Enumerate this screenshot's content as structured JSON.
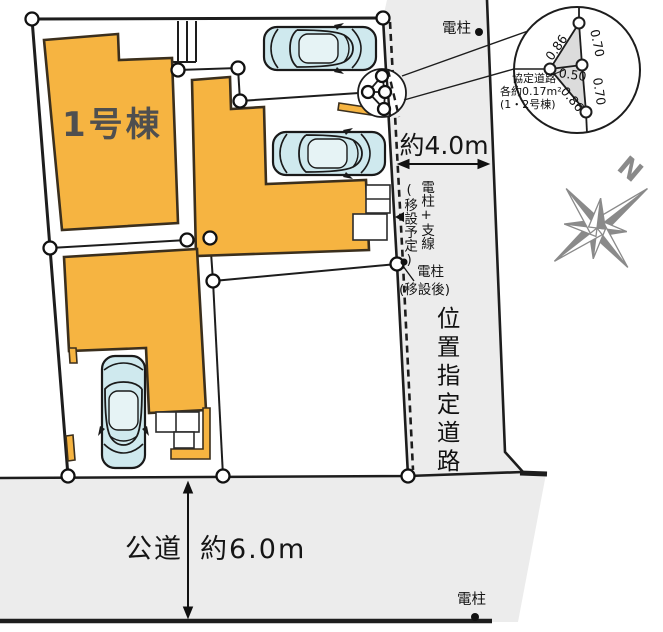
{
  "plan": {
    "building1_label": "1号棟",
    "road_right_name": "位置指定道路",
    "road_right_width": "約4.0m",
    "road_bottom_name": "公道",
    "road_bottom_width": "約6.0m",
    "pole_top_label": "電柱",
    "pole_bottom_label": "電柱",
    "pole_relocation": {
      "line1": "電柱+支線",
      "line2": "(移設予定)"
    },
    "pole_after": {
      "line1": "電柱",
      "line2": "(移設後)"
    },
    "compass_n": "N",
    "detail_circle": {
      "label_line1": "協定道路",
      "label_line2": "各約0.17m²",
      "label_line3": "(1・2号棟)",
      "dim_top_diagonal": "0.86",
      "dim_top_right": "0.70",
      "dim_middle": "0.50",
      "dim_bottom_diagonal": "0.86",
      "dim_bottom_right": "0.70"
    },
    "colors": {
      "building": "#F6B441",
      "road": "#ECECEC",
      "car_body": "#CFE9EE",
      "compass": "#8A8A8A"
    }
  }
}
